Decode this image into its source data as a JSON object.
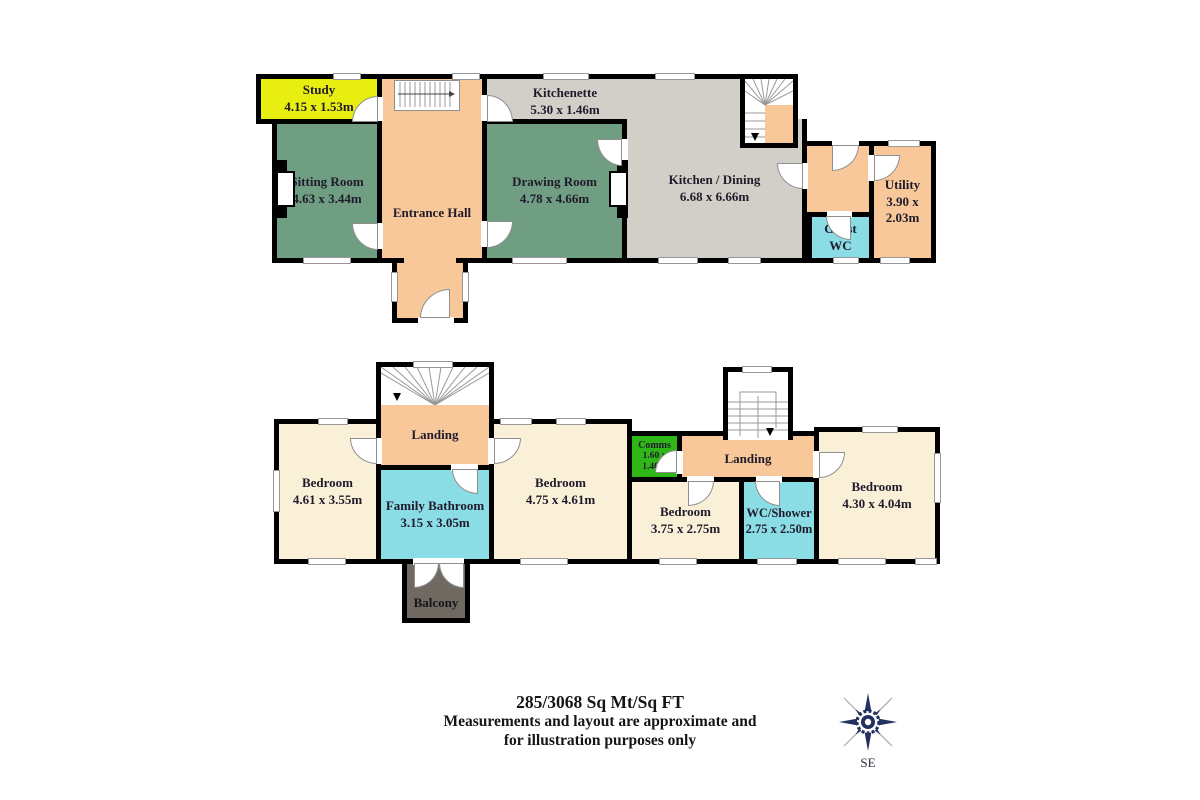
{
  "footer": {
    "area_line": "285/3068 Sq Mt/Sq FT",
    "disclaimer_line1": "Measurements and layout are approximate and",
    "disclaimer_line2": "for illustration purposes only"
  },
  "compass": {
    "direction_label": "SE",
    "color": "#223160"
  },
  "colors": {
    "reception_green": "#6F9E82",
    "hall_orange": "#F8C89B",
    "kitchen_grey": "#D2CFC8",
    "bedroom_cream": "#FAF0D8",
    "bath_cyan": "#8ADDE5",
    "study_yellow": "#E7EE10",
    "comms_green": "#2FB718",
    "balcony_grey": "#6F6962",
    "wall": "#000000"
  },
  "ground_floor": {
    "rooms": {
      "study": {
        "name": "Study",
        "dims": "4.15 x 1.53m"
      },
      "sitting_room": {
        "name": "Sitting Room",
        "dims": "4.63 x 3.44m"
      },
      "entrance_hall": {
        "name": "Entrance Hall",
        "dims": ""
      },
      "kitchenette": {
        "name": "Kitchenette",
        "dims": "5.30 x 1.46m"
      },
      "drawing_room": {
        "name": "Drawing Room",
        "dims": "4.78 x 4.66m"
      },
      "kitchen_dining": {
        "name": "Kitchen / Dining",
        "dims": "6.68 x 6.66m"
      },
      "guest_wc": {
        "name": "Guest WC",
        "dims": ""
      },
      "utility": {
        "name": "Utility",
        "dims": "3.90 x 2.03m"
      }
    }
  },
  "first_floor": {
    "rooms": {
      "bedroom_1": {
        "name": "Bedroom",
        "dims": "4.61 x 3.55m"
      },
      "landing_1": {
        "name": "Landing",
        "dims": ""
      },
      "family_bathroom": {
        "name": "Family Bathroom",
        "dims": "3.15 x 3.05m"
      },
      "bedroom_2": {
        "name": "Bedroom",
        "dims": "4.75 x 4.61m"
      },
      "comms": {
        "name": "Comms",
        "dims": "1.60 x 1.40m"
      },
      "bedroom_3": {
        "name": "Bedroom",
        "dims": "3.75 x 2.75m"
      },
      "wc_shower": {
        "name": "WC/Shower",
        "dims": "2.75 x 2.50m"
      },
      "landing_2": {
        "name": "Landing",
        "dims": ""
      },
      "bedroom_4": {
        "name": "Bedroom",
        "dims": "4.30 x 4.04m"
      },
      "balcony": {
        "name": "Balcony",
        "dims": ""
      }
    }
  }
}
